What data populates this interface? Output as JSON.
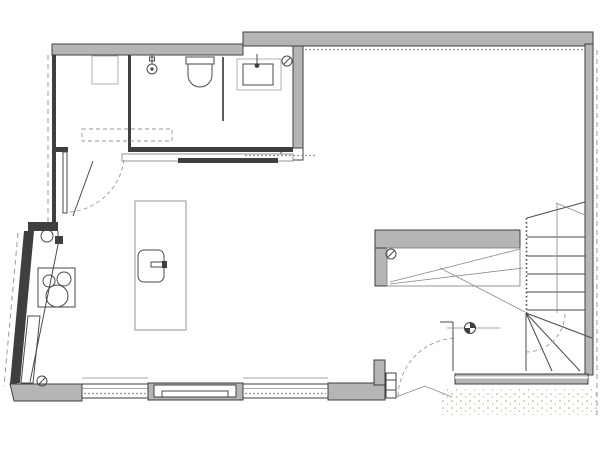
{
  "colors": {
    "paper": "#ffffff",
    "wall-fill": "#b5b5b5",
    "wall-dark": "#3f3f3f",
    "line": "#4a4a4a",
    "line-light": "#8a8a8a",
    "dash": "#9a9a9a",
    "stipple": "#b3a36b"
  },
  "plan": {
    "type": "architectural floor plan, no visible text labels",
    "rooms": [
      {
        "name": "storage-room"
      },
      {
        "name": "shower-room"
      },
      {
        "name": "vanity-wc"
      },
      {
        "name": "kitchen"
      },
      {
        "name": "open-living-area"
      },
      {
        "name": "stair-well"
      },
      {
        "name": "terrace-ground"
      }
    ],
    "fixtures": [
      {
        "name": "toilet"
      },
      {
        "name": "shower-head"
      },
      {
        "name": "glass-screen"
      },
      {
        "name": "wash-basin"
      },
      {
        "name": "storage-cabinet"
      },
      {
        "name": "cooktop"
      },
      {
        "name": "kitchen-counter"
      },
      {
        "name": "kitchen-island"
      },
      {
        "name": "island-sink"
      },
      {
        "name": "dining-counter-wall"
      },
      {
        "name": "entry-door"
      },
      {
        "name": "terrace-door"
      },
      {
        "name": "winder-staircase"
      },
      {
        "name": "level-marker"
      }
    ],
    "stairs": {
      "straight_treads": 5,
      "top_winders": 2,
      "bottom_winders": 3
    },
    "windows": {
      "count": 3
    },
    "drain_symbols": {
      "count": 3
    }
  }
}
